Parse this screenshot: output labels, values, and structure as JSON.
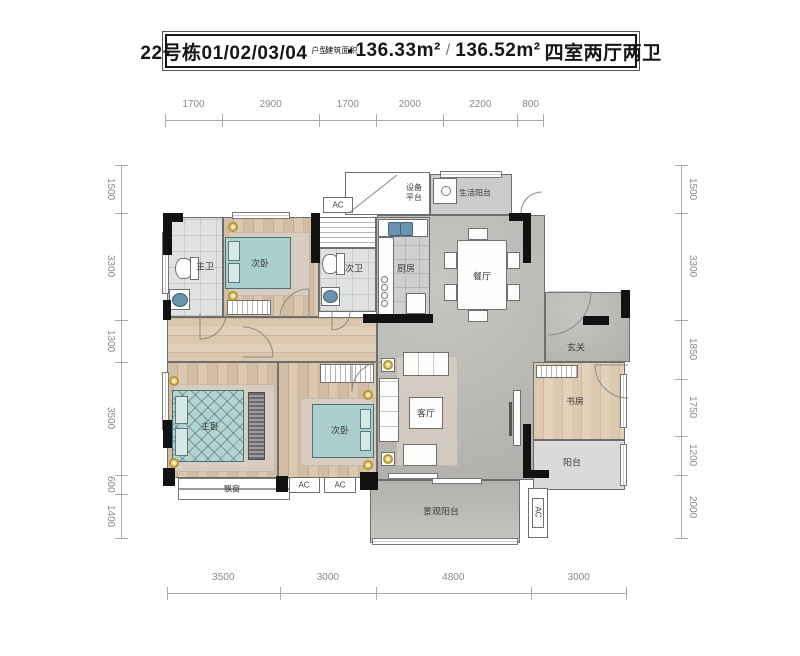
{
  "title": {
    "block": "22号栋01/02/03/04",
    "block_tag": "户型",
    "area_tag": "建筑面积",
    "bullet": "●",
    "area_a": "136.33m²",
    "slash": "/",
    "area_b": "136.52m²",
    "rooms_desc": "四室两厅两卫"
  },
  "dims": {
    "top": [
      "1700",
      "2900",
      "1700",
      "2000",
      "2200",
      "800"
    ],
    "bottom": [
      "3500",
      "3000",
      "4800",
      "3000"
    ],
    "left": [
      "1500",
      "3300",
      "1300",
      "3500",
      "600",
      "1400"
    ],
    "right": [
      "1500",
      "3300",
      "1850",
      "1750",
      "1200",
      "2000"
    ]
  },
  "rooms": {
    "master_bath": "主卫",
    "bedroom2": "次卧",
    "bath2": "次卫",
    "kitchen": "厨房",
    "dining": "餐厅",
    "equip_platform": "设备平台",
    "life_balcony": "生活阳台",
    "foyer": "玄关",
    "living": "客厅",
    "master_bedroom": "主卧",
    "bedroom3": "次卧",
    "study": "书房",
    "balcony": "阳台",
    "view_balcony": "景观阳台",
    "bay_window": "飘窗",
    "ac": "AC"
  },
  "colors": {
    "wall_black": "#121212",
    "bed_teal": "#aacfce",
    "sink_blue": "#6b93ae",
    "wood": "#d2bca3",
    "concrete": "#bab9b6",
    "dim_gray": "#8a8a8a"
  }
}
